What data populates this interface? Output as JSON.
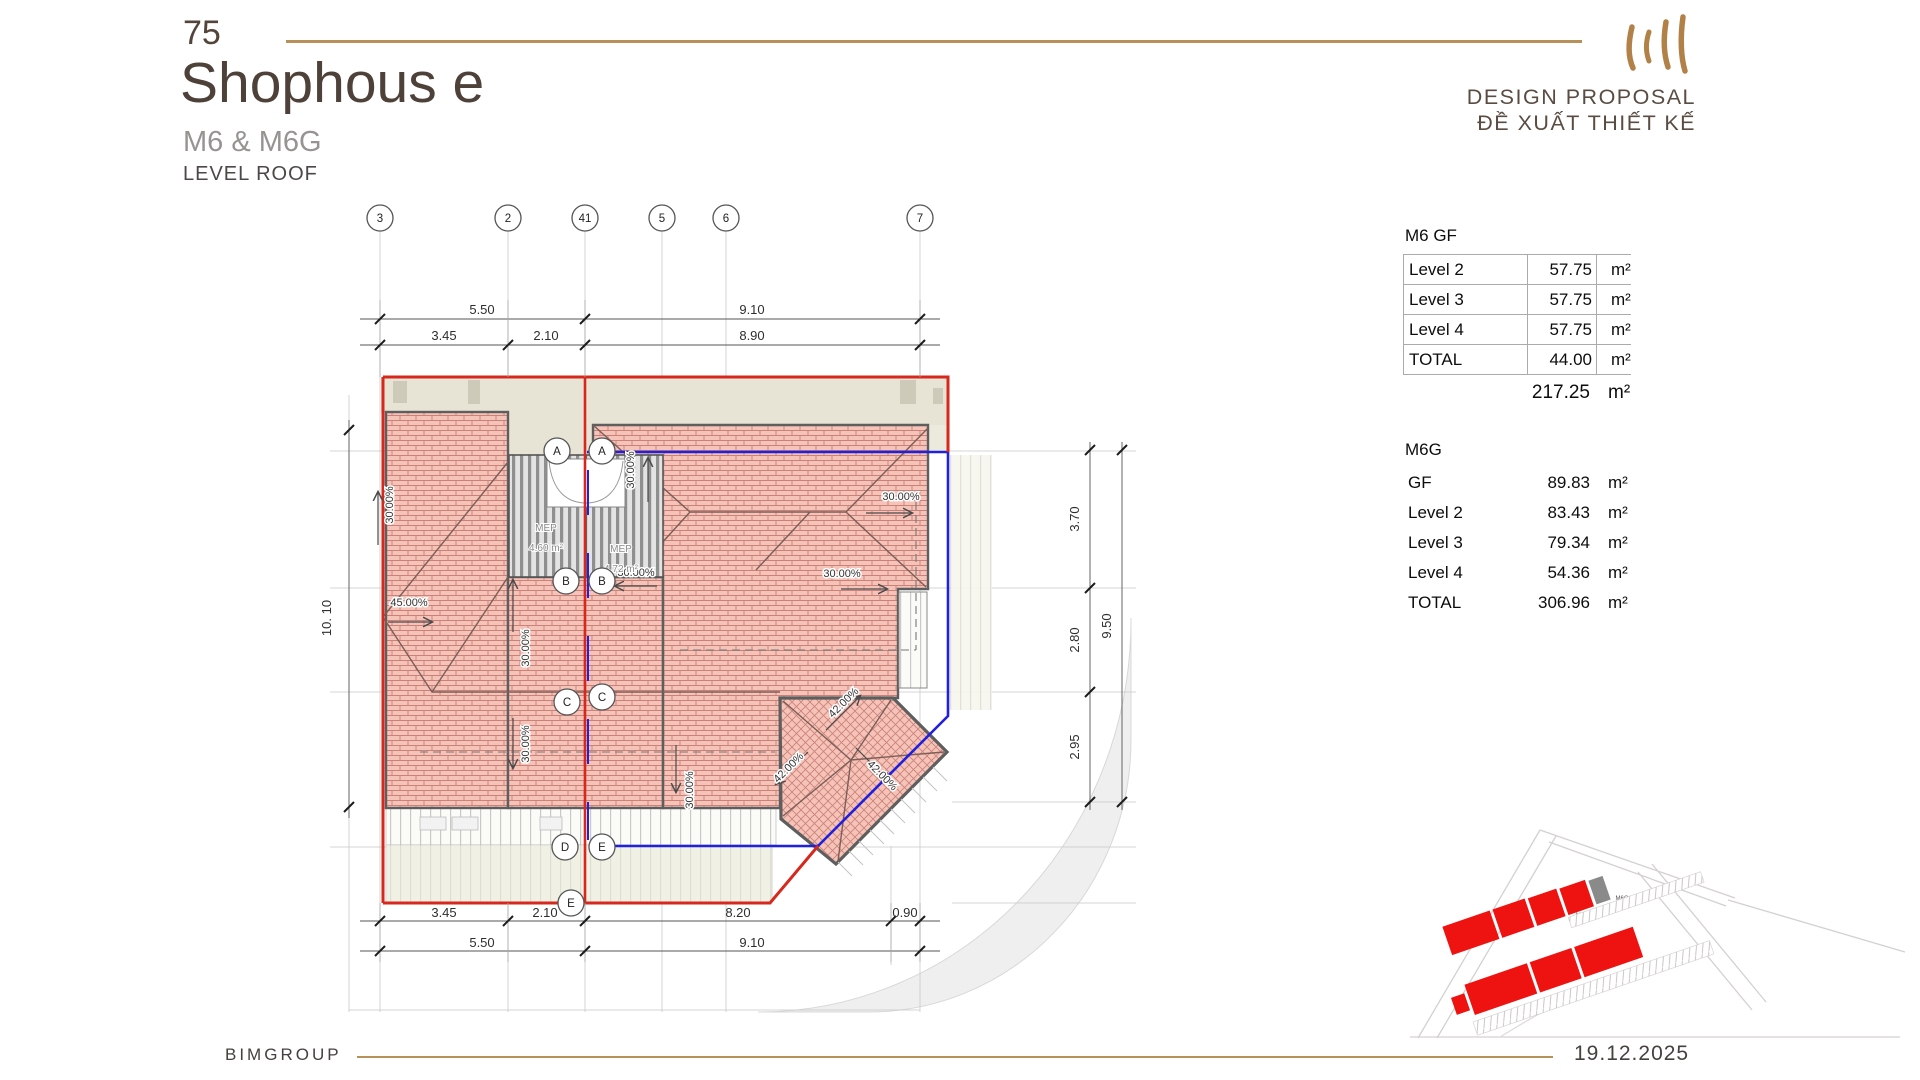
{
  "slide": {
    "page_number": "75",
    "title": "Shophous e",
    "subtitle": "M6 & M6G",
    "level_label": "LEVEL ROOF",
    "proposal_en": "DESIGN PROPOSAL",
    "proposal_vi": "ĐỀ XUẤT THIẾT KẾ",
    "company": "BIMGROUP",
    "date": "19.12.2025"
  },
  "colors": {
    "accent_gold": "#b89158",
    "outline_red": "#d6281c",
    "outline_blue": "#2020dd",
    "roof_pink": "#f6c3b9",
    "brick_line": "#c98179",
    "beige": "#e7e4d6",
    "site_red": "#ee1310",
    "site_gray": "#8a8a8a"
  },
  "area_tables": {
    "m6": {
      "title": "M6  GF",
      "rows": [
        {
          "label": "Level 2",
          "value": "57.75",
          "unit": "m²"
        },
        {
          "label": "Level 3",
          "value": "57.75",
          "unit": "m²"
        },
        {
          "label": "Level 4",
          "value": "57.75",
          "unit": "m²"
        },
        {
          "label": "TOTAL",
          "value": "44.00",
          "unit": "m²"
        }
      ],
      "grand_total_value": "217.25",
      "grand_total_unit": "m²"
    },
    "m6g": {
      "title": "M6G",
      "rows": [
        {
          "label": "GF",
          "value": "89.83",
          "unit": "m²"
        },
        {
          "label": "Level 2",
          "value": "83.43",
          "unit": "m²"
        },
        {
          "label": "Level 3",
          "value": "79.34",
          "unit": "m²"
        },
        {
          "label": "Level 4",
          "value": "54.36",
          "unit": "m²"
        },
        {
          "label": "TOTAL",
          "value": "306.96",
          "unit": "m²"
        }
      ]
    }
  },
  "drawing": {
    "grid_bubbles": [
      {
        "id": "3",
        "x": 380,
        "y": 218
      },
      {
        "id": "2",
        "x": 508,
        "y": 218
      },
      {
        "id": "41",
        "x": 585,
        "y": 218
      },
      {
        "id": "5",
        "x": 662,
        "y": 218
      },
      {
        "id": "6",
        "x": 726,
        "y": 218
      },
      {
        "id": "7",
        "x": 920,
        "y": 218
      },
      {
        "id": "A",
        "x": 557,
        "y": 451
      },
      {
        "id": "A",
        "x": 602,
        "y": 451
      },
      {
        "id": "B",
        "x": 566,
        "y": 581
      },
      {
        "id": "B",
        "x": 602,
        "y": 581
      },
      {
        "id": "C",
        "x": 567,
        "y": 702
      },
      {
        "id": "C",
        "x": 602,
        "y": 697
      },
      {
        "id": "D",
        "x": 565,
        "y": 847
      },
      {
        "id": "E",
        "x": 602,
        "y": 847
      },
      {
        "id": "E",
        "x": 571,
        "y": 903
      }
    ],
    "labels": [
      {
        "t": "5.50",
        "x": 482,
        "y": 314,
        "c": "dim"
      },
      {
        "t": "9.10",
        "x": 752,
        "y": 314,
        "c": "dim"
      },
      {
        "t": "3.45",
        "x": 444,
        "y": 340,
        "c": "dim"
      },
      {
        "t": "2.10",
        "x": 546,
        "y": 340,
        "c": "dim"
      },
      {
        "t": "8.90",
        "x": 752,
        "y": 340,
        "c": "dim"
      },
      {
        "t": "3.45",
        "x": 444,
        "y": 917,
        "c": "dim"
      },
      {
        "t": "2.10",
        "x": 545,
        "y": 917,
        "c": "dim"
      },
      {
        "t": "8.20",
        "x": 738,
        "y": 917,
        "c": "dim"
      },
      {
        "t": "0.90",
        "x": 905,
        "y": 917,
        "c": "dim"
      },
      {
        "t": "5.50",
        "x": 482,
        "y": 947,
        "c": "dim"
      },
      {
        "t": "9.10",
        "x": 752,
        "y": 947,
        "c": "dim"
      },
      {
        "t": "10. 10",
        "x": 331,
        "y": 618,
        "r": -90,
        "c": "dim"
      },
      {
        "t": "3.70",
        "x": 1079,
        "y": 519,
        "r": -90,
        "c": "dim"
      },
      {
        "t": "2.80",
        "x": 1079,
        "y": 640,
        "r": -90,
        "c": "dim"
      },
      {
        "t": "2.95",
        "x": 1079,
        "y": 747,
        "r": -90,
        "c": "dim"
      },
      {
        "t": "9.50",
        "x": 1111,
        "y": 626,
        "r": -90,
        "c": "dim"
      },
      {
        "t": "30.00%",
        "x": 393,
        "y": 505,
        "r": -90,
        "c": "slope"
      },
      {
        "t": "45.00%",
        "x": 409,
        "y": 606,
        "c": "slope"
      },
      {
        "t": "30.00%",
        "x": 529,
        "y": 648,
        "r": -90,
        "c": "slope"
      },
      {
        "t": "30.00%",
        "x": 529,
        "y": 744,
        "r": -90,
        "c": "slope"
      },
      {
        "t": "30.00%",
        "x": 634,
        "y": 470,
        "r": -90,
        "c": "slope"
      },
      {
        "t": "30.00%",
        "x": 901,
        "y": 500,
        "c": "slope"
      },
      {
        "t": "30.00%",
        "x": 636,
        "y": 576,
        "c": "slope"
      },
      {
        "t": "30.00%",
        "x": 842,
        "y": 577,
        "c": "slope"
      },
      {
        "t": "30.00%",
        "x": 693,
        "y": 790,
        "r": -90,
        "c": "slope"
      },
      {
        "t": "42.00%",
        "x": 846,
        "y": 705,
        "r": -45,
        "c": "slope"
      },
      {
        "t": "42.00%",
        "x": 791,
        "y": 770,
        "r": -45,
        "c": "slope"
      },
      {
        "t": "42.00%",
        "x": 880,
        "y": 778,
        "r": 45,
        "c": "slope"
      },
      {
        "t": "MEP",
        "x": 546,
        "y": 531,
        "c": "mep"
      },
      {
        "t": "4.60 m²",
        "x": 546,
        "y": 551,
        "c": "mep"
      },
      {
        "t": "MEP",
        "x": 621,
        "y": 552,
        "c": "mep"
      },
      {
        "t": "4.72 m²",
        "x": 621,
        "y": 572,
        "c": "mep"
      },
      {
        "t": "M6",
        "x": 1580,
        "y": 917,
        "c": "site"
      },
      {
        "t": "M6G",
        "x": 1622,
        "y": 900,
        "c": "site"
      }
    ]
  }
}
